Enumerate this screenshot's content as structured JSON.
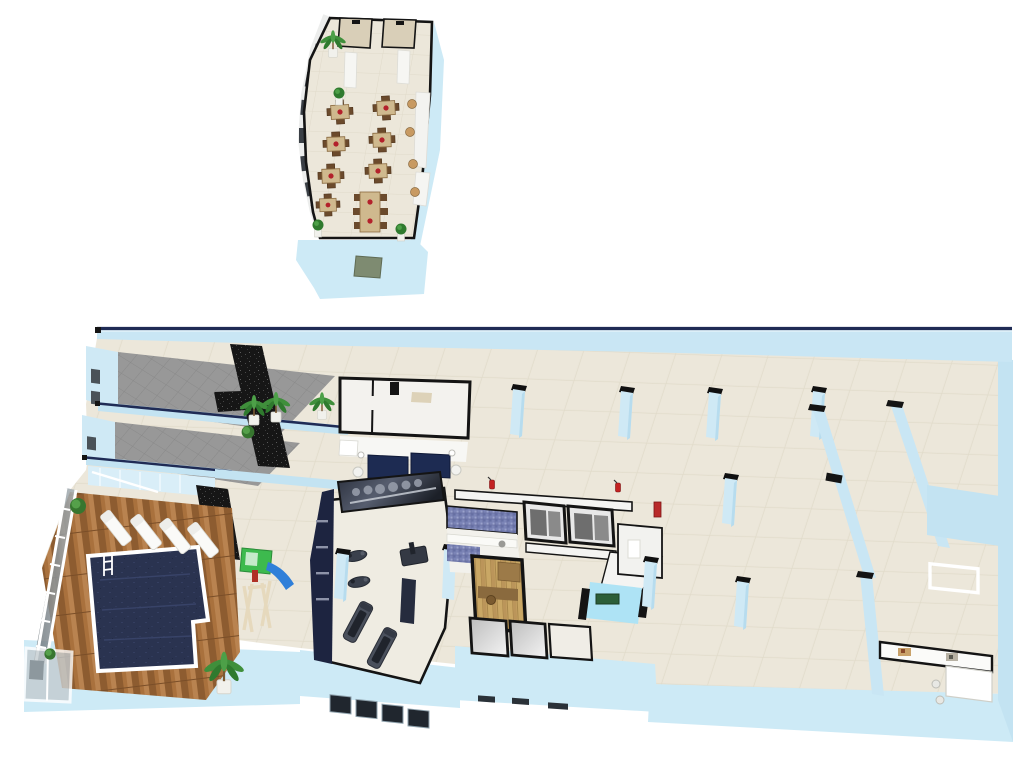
{
  "scene": {
    "kind": "3d-isometric-floorplan-render",
    "background_color": "#ffffff",
    "palette": {
      "wall_light_blue": "#c9e6f4",
      "wall_light_blue_bright": "#dff0f9",
      "wall_top_navy": "#1f2b55",
      "floor_beige": "#eae5d8",
      "restaurant_floor": "#ece7da",
      "black_stone_wall": "#181818",
      "ramp_gray": "#979797",
      "pool_water_navy": "#2a3350",
      "deck_wood": "#a9713d",
      "sauna_wood": "#c9a765",
      "mosaic_tile_blue": "#7b84b6",
      "white_wall": "#f4f4f2",
      "sofa_navy": "#1d2b52",
      "exit_sign_green": "#2c5e38",
      "extinguisher_red": "#c32222",
      "slide_blue": "#2f7fd9",
      "playhouse_green": "#3dba4e",
      "vent_green_gray": "#7e8b71",
      "table_wood": "#cfb98e",
      "chair_wood": "#6b4a2c",
      "centerpiece_red": "#b3212b",
      "plant_green": "#3f8f3b"
    },
    "floors": [
      {
        "id": "upper-floor-restaurant",
        "label": "upper floor restaurant",
        "objects": {
          "dining_tables_small": 6,
          "dining_table_long": 1,
          "chairs_total": 30,
          "red_table_centerpieces": 7,
          "potted_topiaries": 3,
          "palm_plant": 1,
          "side_tables": 4,
          "window_wall": "curved left facade with dark windows",
          "restroom_stalls": 2,
          "white_columns": 2,
          "facade_vent": 1
        }
      },
      {
        "id": "ground-floor-fitness-spa-parking",
        "label": "ground floor with pool, gym, spa and parking hall",
        "areas": [
          "ramp-room-upper",
          "ramp-room-lower",
          "staircase",
          "pool-deck",
          "swimming-pool",
          "kids-playground",
          "lounge",
          "white-room",
          "gym",
          "blue-mosaic-bathroom",
          "sauna",
          "shower-rooms",
          "elevator-lobby",
          "parking-hall",
          "corner-office"
        ],
        "objects": {
          "sun_loungers": 4,
          "pool_ladder": 1,
          "glass_facade_panels": 8,
          "glass_shower_cabin": 1,
          "palm_plants": 4,
          "bushes": 3,
          "black_stone_accent_walls": 4,
          "treadmills": 2,
          "exercise_bikes": 2,
          "weight_station": 1,
          "gym_mural_wall": 1,
          "navy_sofas": 2,
          "floor_lamps": 2,
          "elevators": 2,
          "fire_extinguishers": 3,
          "green_wall_sign": 1,
          "parking_columns": 8,
          "corner_office_art_pictures": 2,
          "corner_office_desk": 1
        }
      }
    ]
  }
}
